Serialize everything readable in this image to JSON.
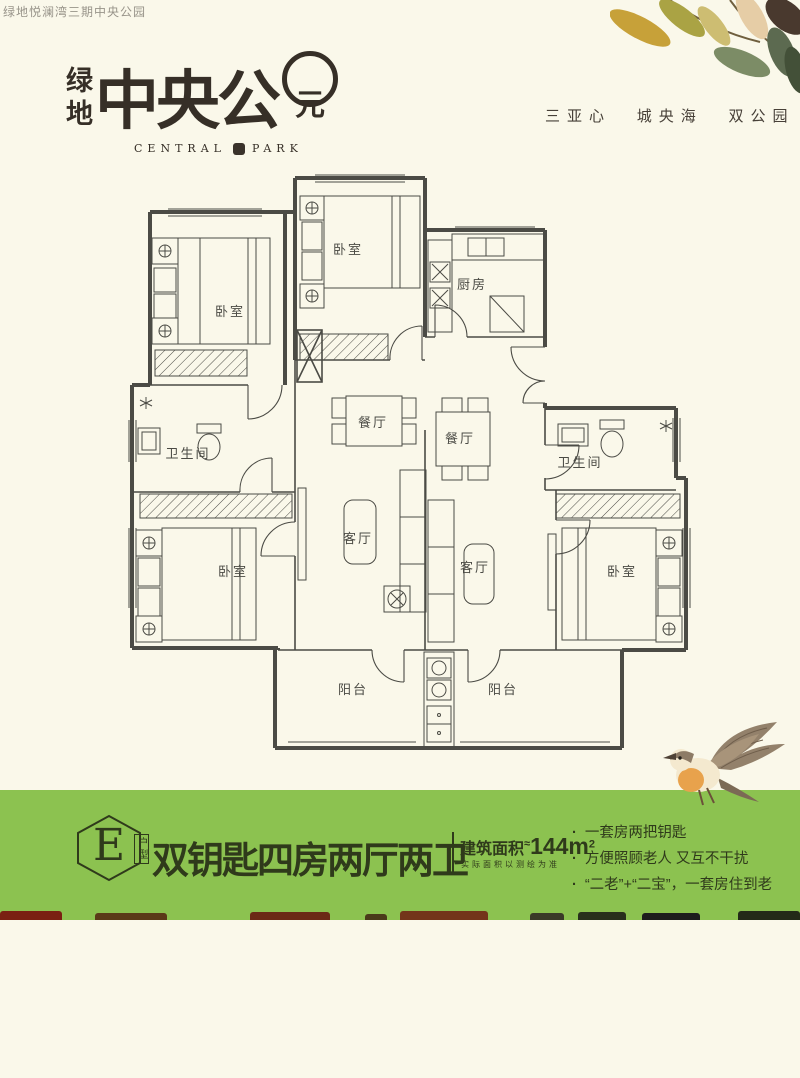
{
  "colors": {
    "background": "#FAF8EA",
    "banner_green": "#8CC250",
    "ink": "#2F3A1B",
    "plan_line": "#4B4B45"
  },
  "header": {
    "corner_text": "绿地悦澜湾三期中央公园",
    "logo": {
      "vertical": "绿地",
      "main": "中央公",
      "seal_char": "元",
      "sub_left": "CENTRAL",
      "sub_right": "PARK"
    },
    "tagline": "三亚心 城央海 双公园"
  },
  "floorplan": {
    "rooms": [
      "卧室",
      "卧室",
      "厨房",
      "卫生间",
      "餐厅",
      "餐厅",
      "卫生间",
      "客厅",
      "客厅",
      "卧室",
      "卧室",
      "阳台",
      "阳台"
    ]
  },
  "banner": {
    "badge_letter": "E",
    "badge_suffix": "户型",
    "title": "双钥匙四房两厅两卫",
    "area_label": "建筑面积",
    "area_tilde": "≈",
    "area_value": "144m",
    "area_sup": "2",
    "disclaimer": "实际面积以测绘为准",
    "bullets": [
      "一套房两把钥匙",
      "方便照顾老人 又互不干扰",
      "“二老”+“二宝”，一套房住到老"
    ]
  }
}
